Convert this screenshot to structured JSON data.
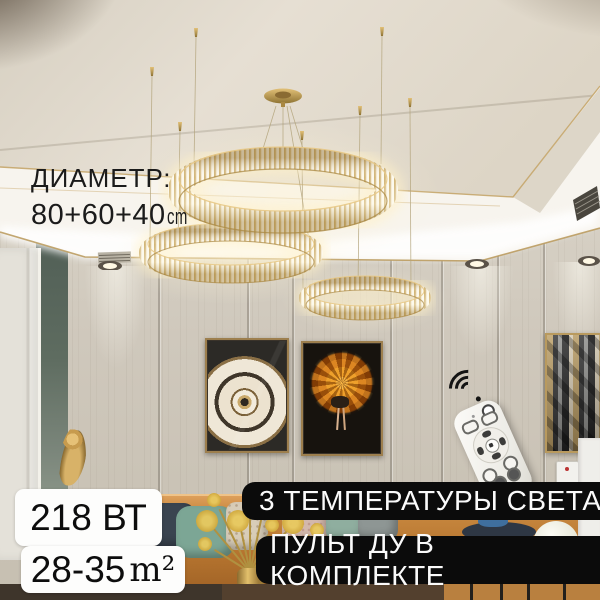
{
  "overlay": {
    "diameter": {
      "label": "ДИАМЕТР:",
      "value": "80+60+40",
      "unit": "cm"
    },
    "badges": {
      "power": "218 ВТ",
      "area_value": "28-35",
      "area_unit": "m²",
      "feature_temperatures": "3 ТЕМПЕРАТУРЫ СВЕТА",
      "feature_remote": "ПУЛЬТ ДУ В КОМПЛЕКТЕ"
    }
  },
  "icons": {
    "wifi": "wifi-signal"
  },
  "colors": {
    "gold_accent": "#c9a85f",
    "ceiling_beige": "#e4ddd1",
    "wall_panel": "#cfc8bc",
    "wall_teal": "#5e6c60",
    "sofa_tan": "#c8883f",
    "badge_black_bg": "#0b0b0b",
    "badge_white_bg": "#fdfdfc",
    "warm_glow": "#fff3d2",
    "text_dark": "#1b1b1b",
    "text_light": "#fafafa"
  }
}
